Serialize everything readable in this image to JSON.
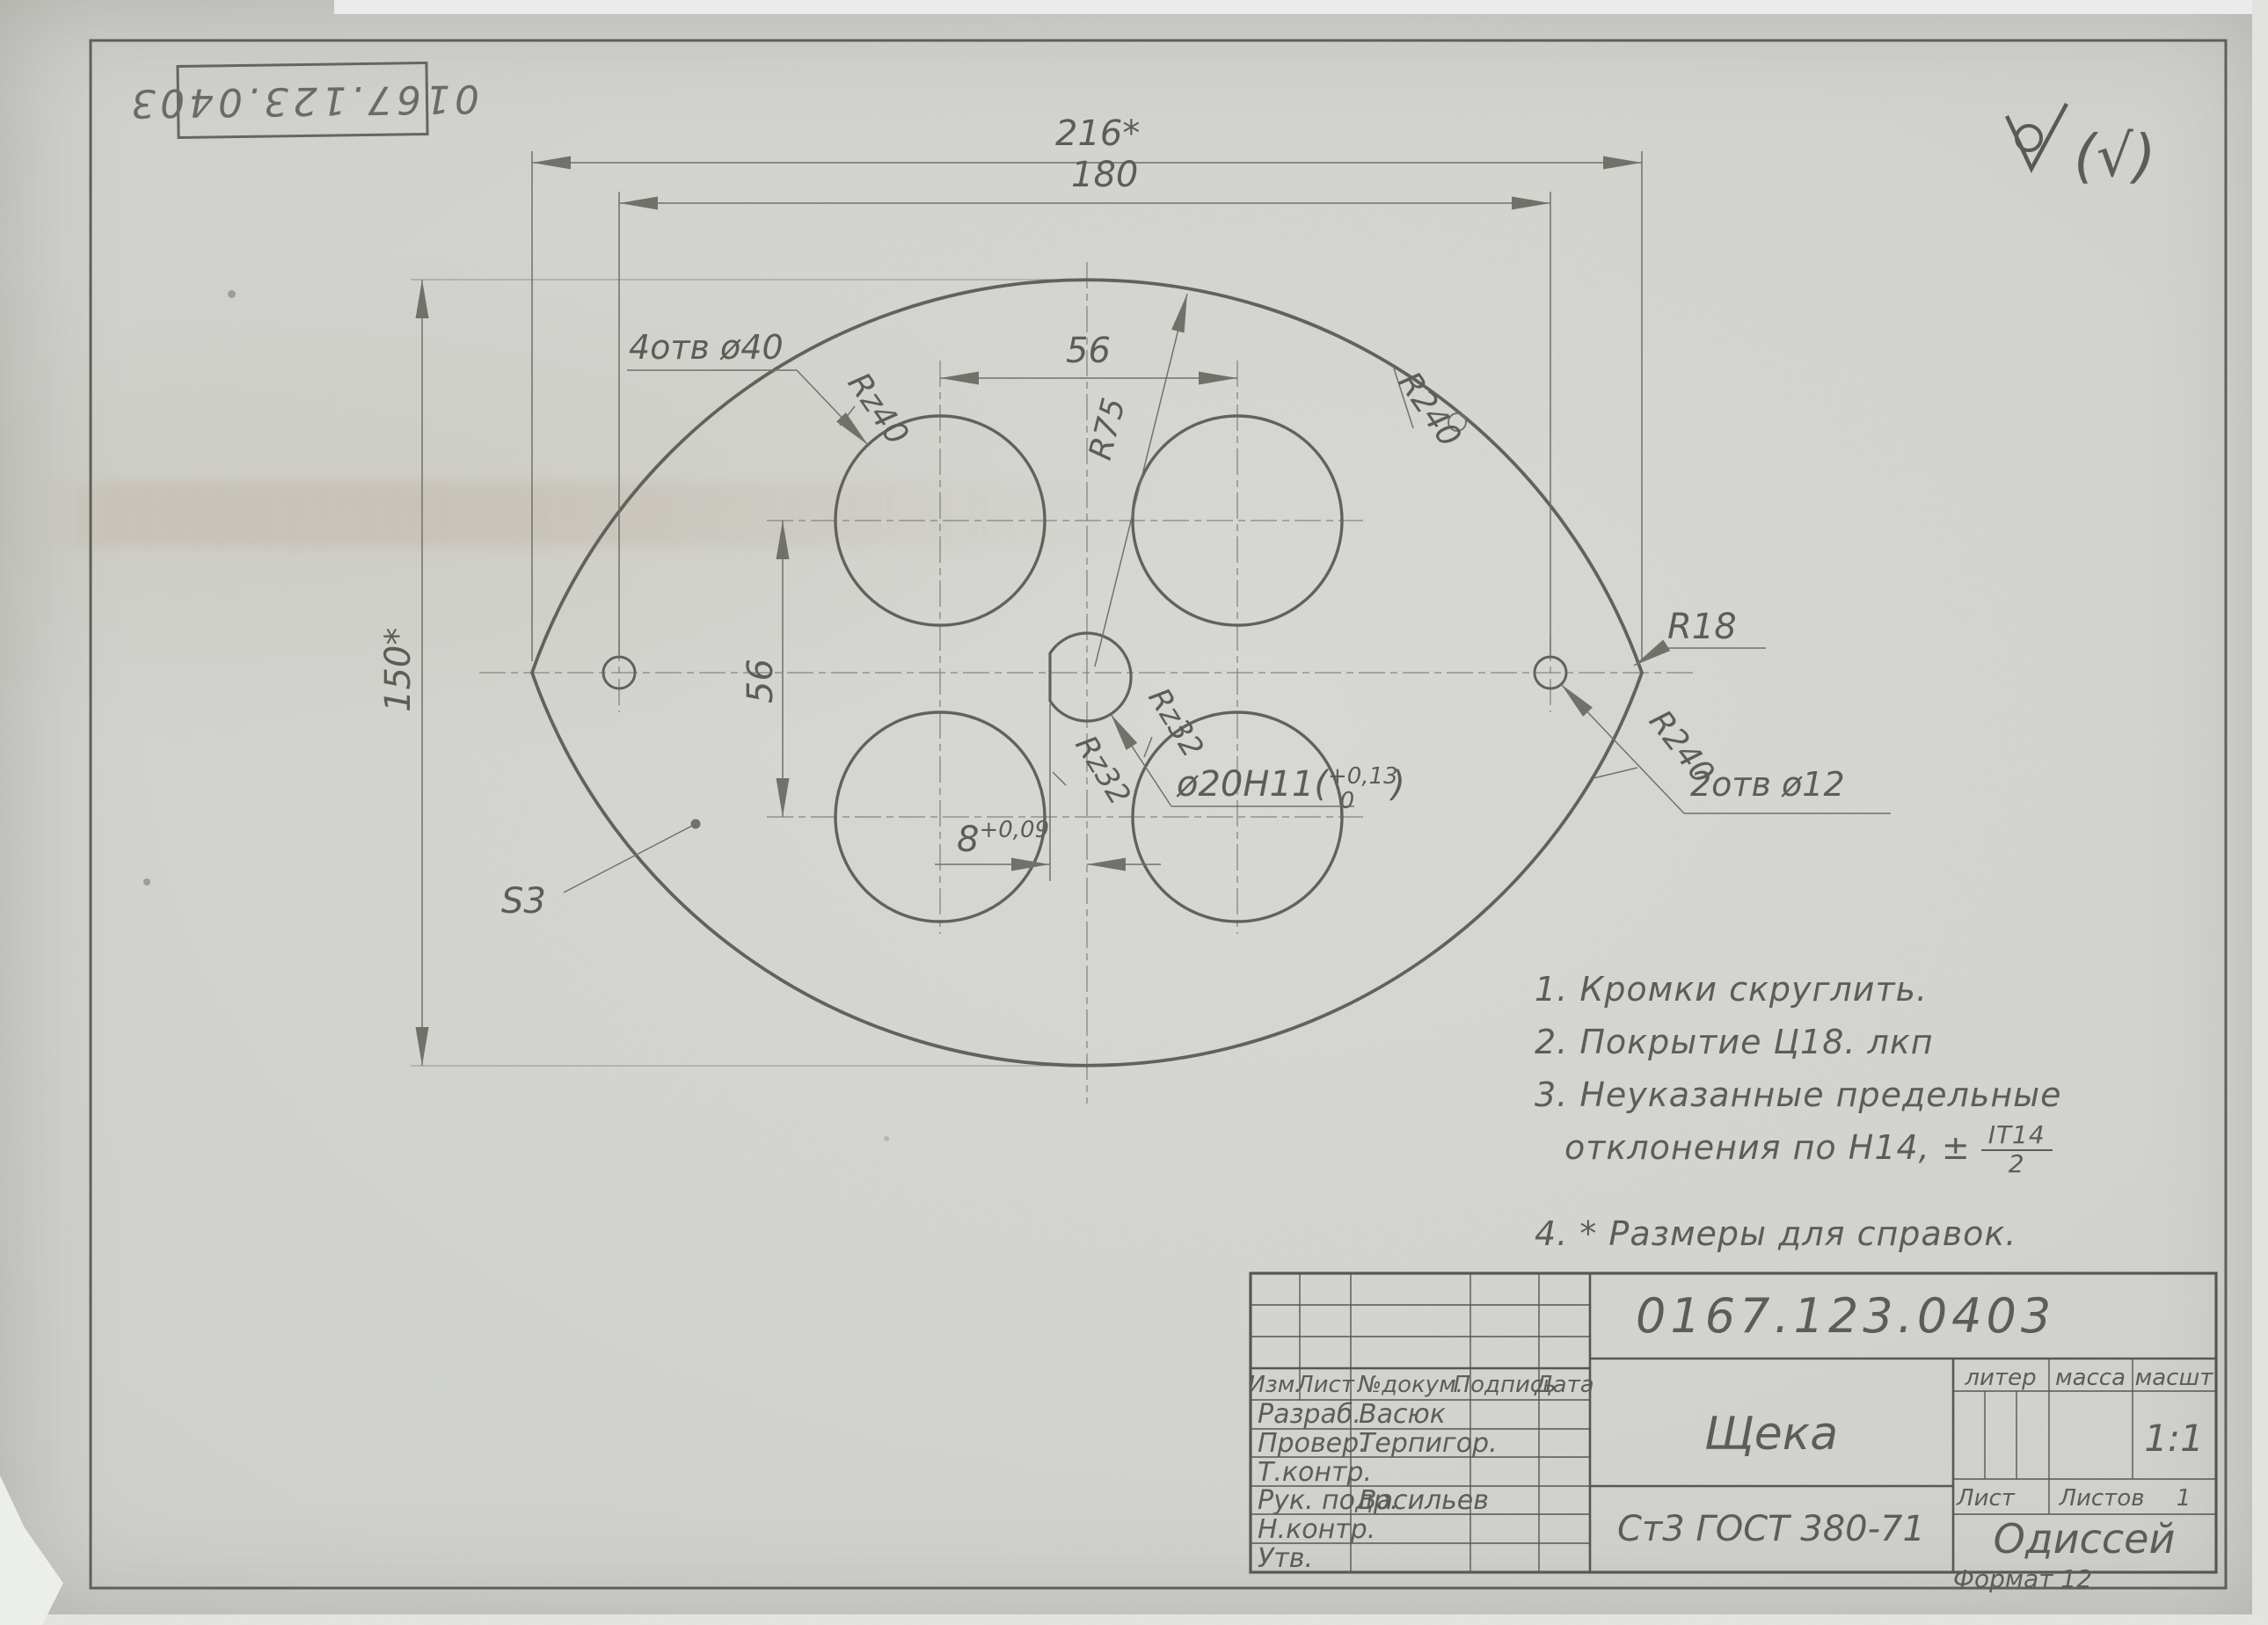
{
  "corner": {
    "stamp_number": "0167.123.0403",
    "bracket_mark": "(√)"
  },
  "drawing": {
    "dim_216": "216*",
    "dim_180": "180",
    "dim_150": "150*",
    "dim_56_top": "56",
    "dim_56_left": "56",
    "dim_8_value": "8",
    "dim_8_tol": "+0,09",
    "r240_top": "R240",
    "r240_bottom": "R240",
    "rz40": "Rz40",
    "rz32_a": "Rz32",
    "rz32_b": "Rz32",
    "r75": "R75",
    "r18": "R18",
    "holes_large": "4отв ø40",
    "holes_small": "2отв ø12",
    "center_hole_label": "ø20Н11(",
    "center_hole_tol_upper": "+0,13",
    "center_hole_tol_lower": "0",
    "center_hole_close": ")",
    "thickness": "S3"
  },
  "notes": {
    "line1": "1. Кромки  скруглить.",
    "line2": "2. Покрытие Ц18. лкп",
    "line3a": "3. Неуказанные  предельные",
    "line3b": "отклонения по Н14, ±",
    "line3_frac_top": "IT14",
    "line3_frac_bottom": "2",
    "line4": "4. * Размеры для справок."
  },
  "titleblock": {
    "doc_number": "0167.123.0403",
    "part_name": "Щека",
    "material": "Ст3 ГОСТ 380-71",
    "organization": "Одиссей",
    "scale_value": "1:1",
    "header": {
      "izm": "Изм.",
      "list": "Лист",
      "docnum": "№докум.",
      "podpis": "Подпись",
      "data": "Дата"
    },
    "cols_right": {
      "liter": "литер",
      "massa": "масса",
      "masshtab": "масшт"
    },
    "sheet_row": {
      "list": "Лист",
      "listov": "Листов",
      "listov_value": "1"
    },
    "rows": [
      {
        "role": "Разраб.",
        "name": "Васюк"
      },
      {
        "role": "Провер.",
        "name": "Терпигор."
      },
      {
        "role": "Т.контр.",
        "name": ""
      },
      {
        "role": "Рук. подр.",
        "name": "Васильев"
      },
      {
        "role": "Н.контр.",
        "name": ""
      },
      {
        "role": "Утв.",
        "name": ""
      }
    ],
    "format_note": "Формат 12"
  }
}
